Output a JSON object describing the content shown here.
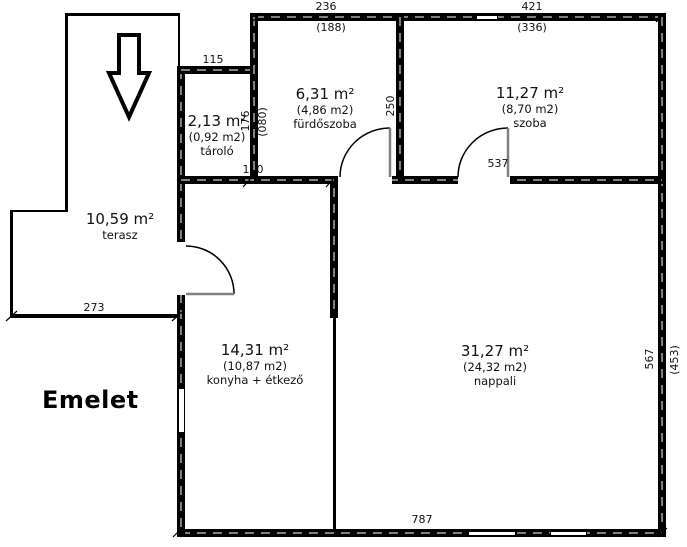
{
  "title": "Emelet",
  "rooms": [
    {
      "id": "terasz",
      "area": "10,59 m²",
      "area_net": "",
      "name": "terasz"
    },
    {
      "id": "tarolo",
      "area": "2,13 m²",
      "area_net": "(0,92 m2)",
      "name": "tároló"
    },
    {
      "id": "furdoszoba",
      "area": "6,31 m²",
      "area_net": "(4,86 m2)",
      "name": "fürdőszoba"
    },
    {
      "id": "szoba",
      "area": "11,27 m²",
      "area_net": "(8,70 m2)",
      "name": "szoba"
    },
    {
      "id": "konyha",
      "area": "14,31 m²",
      "area_net": "(10,87 m2)",
      "name": "konyha + étkező"
    },
    {
      "id": "nappali",
      "area": "31,27 m²",
      "area_net": "(24,32 m2)",
      "name": "nappali"
    }
  ],
  "dimensions": {
    "furdoszoba_width": "236",
    "furdoszoba_width_net": "(188)",
    "szoba_width": "421",
    "szoba_width_net": "(336)",
    "tarolo_width": "115",
    "tarolo_height": "176",
    "tarolo_door": "(080)",
    "furdoszoba_height": "250",
    "mid_small": "110",
    "szoba_bottom": "537",
    "terasz_width": "273",
    "building_width": "787",
    "building_height": "567",
    "building_height_net": "(453)"
  },
  "colors": {
    "wall": "#000000",
    "door_leaf": "#808080",
    "background": "#ffffff",
    "text": "#111111"
  }
}
